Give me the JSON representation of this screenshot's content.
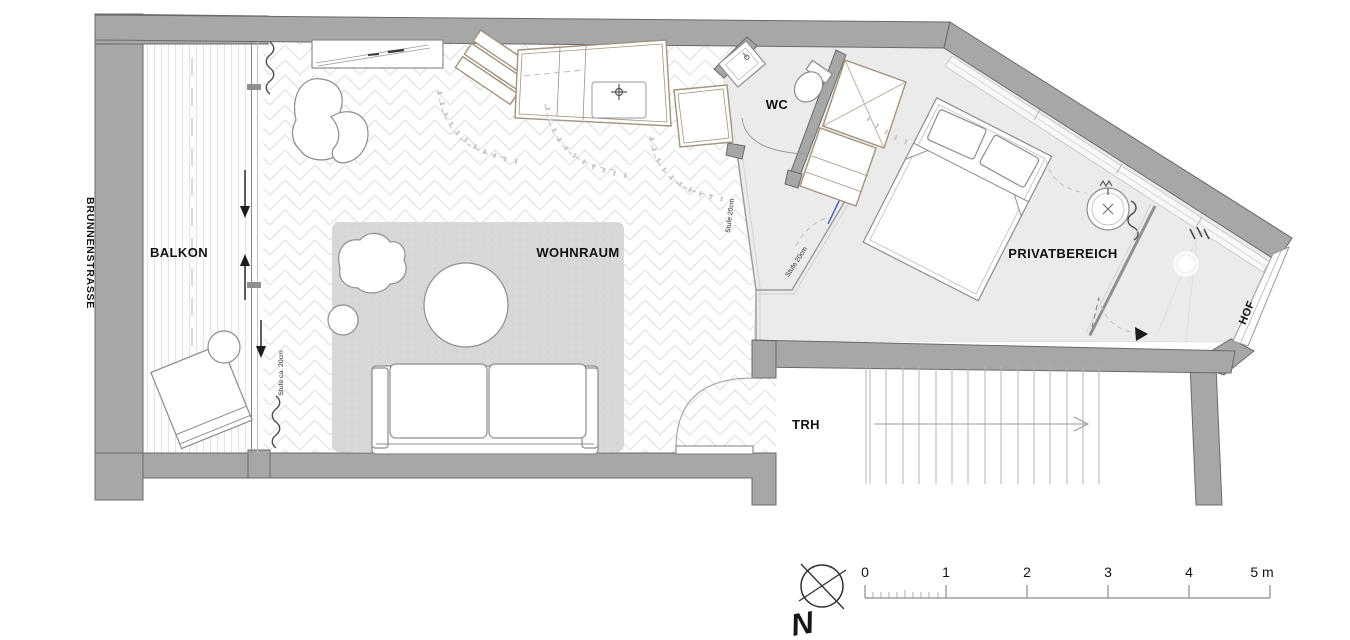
{
  "plan": {
    "street_label": "BRUNNENSTRASSE",
    "rooms": {
      "balcony": "BALKON",
      "living_room": "WOHNRAUM",
      "wc": "WC",
      "private_area": "PRIVATBEREICH",
      "stairwell": "TRH",
      "courtyard": "HOF"
    },
    "step_notes": {
      "balcony_step": "Stufe ca. 20cm",
      "wc_step": "Stufe 20cm",
      "private_step": "Stufe 20cm"
    }
  },
  "scale_bar": {
    "unit_labels": [
      "0",
      "1",
      "2",
      "3",
      "4",
      "5 m"
    ]
  },
  "north_indicator": {
    "label": "N"
  },
  "colors": {
    "wall": "#a7a7a7",
    "wall_outline": "#6a6a6a",
    "floor_private": "#ebebeb",
    "rug": "#d8d8d8",
    "furniture_outline": "#8c8c8c",
    "wood_outline": "#a3927d",
    "annotation": "#111111"
  }
}
